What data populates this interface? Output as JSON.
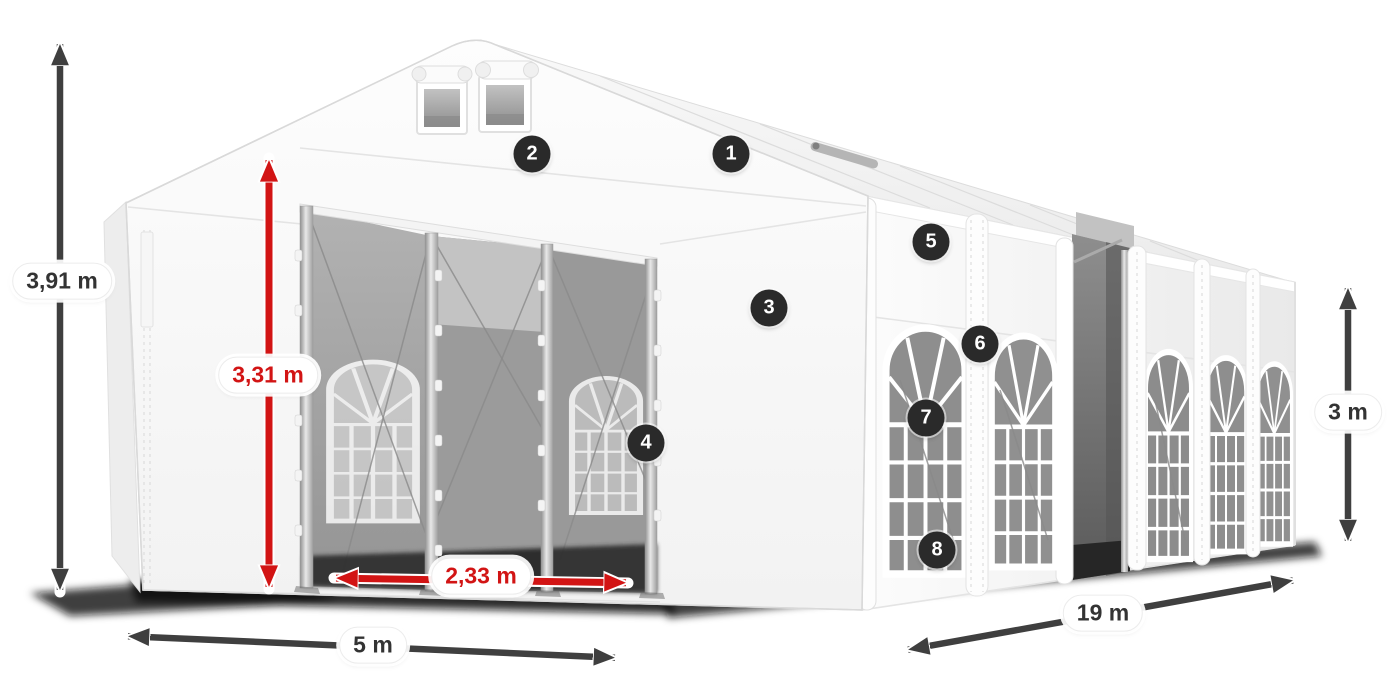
{
  "figure": {
    "description": "White marquee party tent in three-quarter view with two open front entrances, arched side windows, numbered part callouts and dimension arrows"
  },
  "dimensions": {
    "total_height": {
      "label": "3,91 m",
      "color": "dark"
    },
    "entrance_height": {
      "label": "3,31 m",
      "color": "red"
    },
    "entrance_width": {
      "label": "2,33 m",
      "color": "red"
    },
    "front_width": {
      "label": "5 m",
      "color": "dark"
    },
    "side_length": {
      "label": "19 m",
      "color": "dark"
    },
    "side_height": {
      "label": "3 m",
      "color": "dark"
    }
  },
  "badges": [
    {
      "number": "1"
    },
    {
      "number": "2"
    },
    {
      "number": "3"
    },
    {
      "number": "4"
    },
    {
      "number": "5"
    },
    {
      "number": "6"
    },
    {
      "number": "7"
    },
    {
      "number": "8"
    }
  ],
  "colors": {
    "accent-red": "#d21414",
    "arrow-dark": "#3f3f3f",
    "badge-bg": "#2a2a2a",
    "label-text": "#333333",
    "tent-outline": "#d9d9d9",
    "background": "#ffffff"
  }
}
